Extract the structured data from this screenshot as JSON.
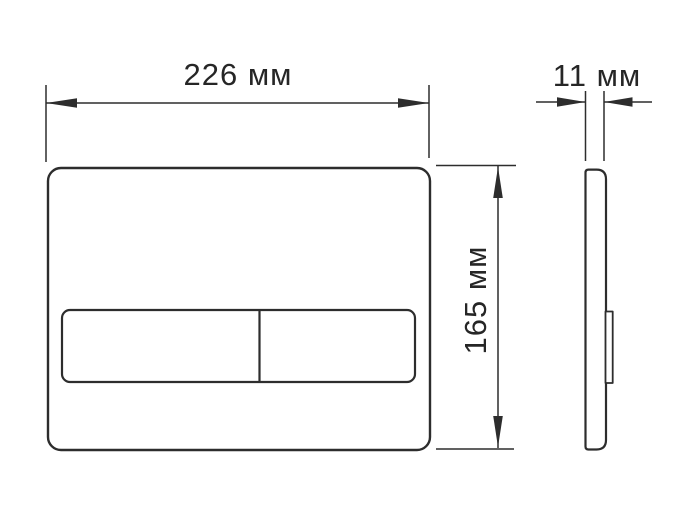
{
  "drawing": {
    "subject": "flush-plate-technical-drawing",
    "background_color": "#ffffff",
    "line_color": "#2d2d2d",
    "text_color": "#262626",
    "views": {
      "front_view": "front view of flush plate with two buttons",
      "side_view": "side profile of flush plate with button protrusion"
    },
    "dimensions": {
      "width": {
        "value": 226,
        "unit": "мм",
        "label": "226 мм"
      },
      "depth": {
        "value": 11,
        "unit": "мм",
        "label": "11 мм"
      },
      "height": {
        "value": 165,
        "unit": "мм",
        "label": "165 мм"
      }
    }
  }
}
